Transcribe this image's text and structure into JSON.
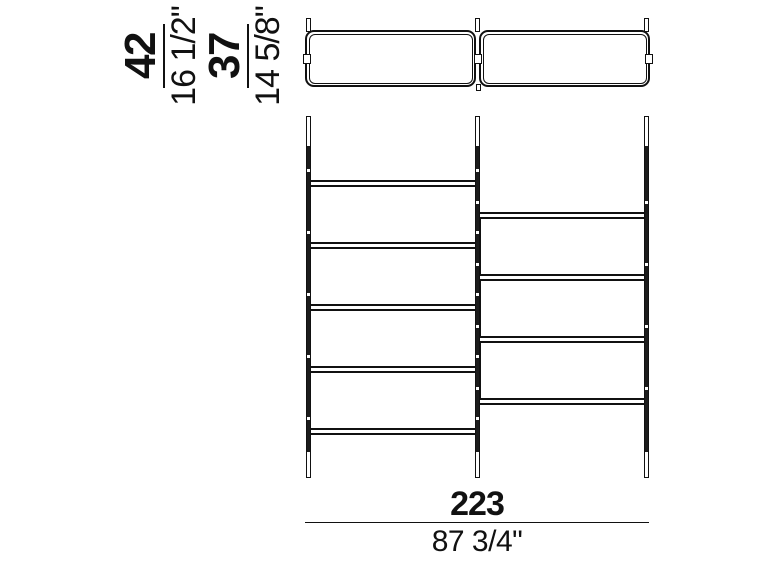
{
  "dimensions": {
    "depth_overall": {
      "cm": "42",
      "inches": "16 1/2\""
    },
    "depth_shelf": {
      "cm": "37",
      "inches": "14 5/8\""
    },
    "width": {
      "cm": "223",
      "inches": "87 3/4\""
    }
  },
  "structure": {
    "bays": 2,
    "posts": 3,
    "left_shelf_count": 5,
    "right_shelf_count": 4
  },
  "colors": {
    "line": "#111111",
    "background": "#ffffff"
  }
}
